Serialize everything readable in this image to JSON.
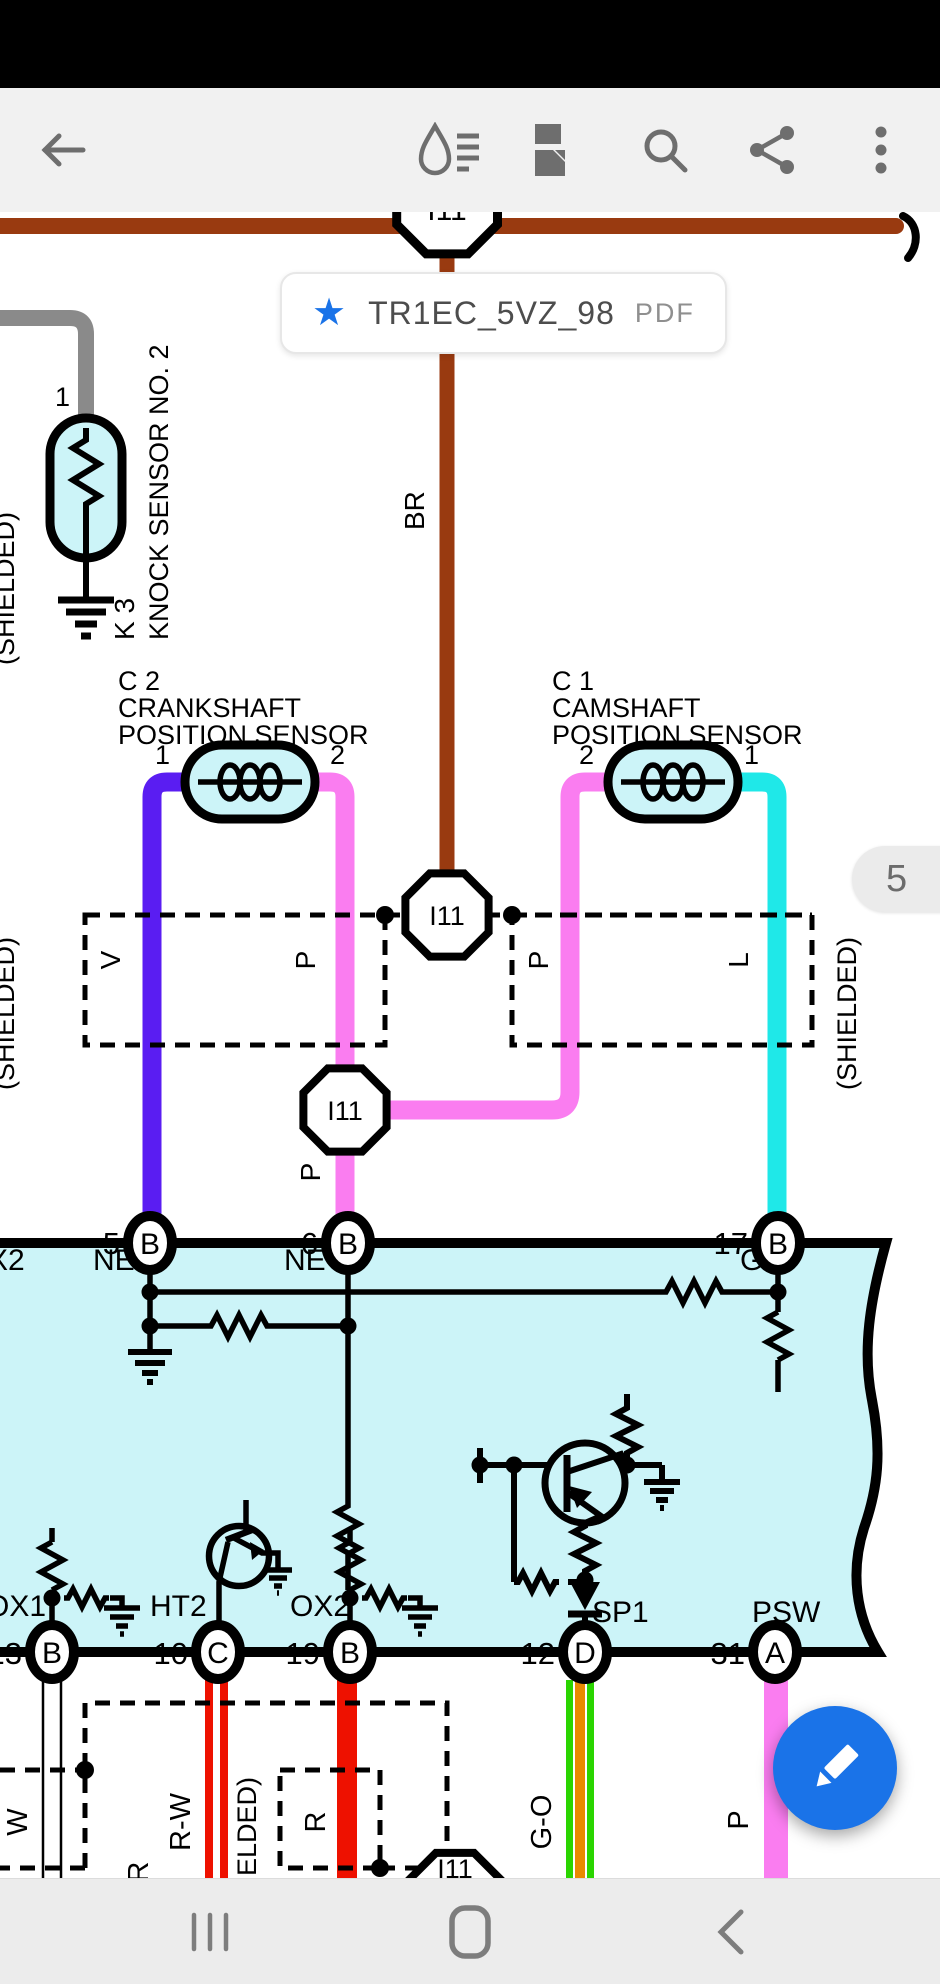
{
  "status_bar": {
    "background": "#000000"
  },
  "toolbar": {
    "background": "#f1f1f1",
    "icon_color": "#6e6e6e",
    "icons": [
      "back",
      "annotate",
      "page-layout",
      "search",
      "share",
      "more"
    ]
  },
  "doc_chip": {
    "title": "TR1EC_5VZ_98",
    "badge": "PDF",
    "star_color": "#1a73e8"
  },
  "page_indicator": {
    "label": "5"
  },
  "fab": {
    "icon": "pencil",
    "color": "#1a73e8"
  },
  "nav_bar": {
    "icons": [
      "recents",
      "home",
      "back"
    ]
  },
  "diagram": {
    "colors": {
      "ecu_fill": "#ccf4f8",
      "brown": "#993a10",
      "violet": "#5a1df2",
      "pink": "#fa7df0",
      "cyan": "#1fe8e8",
      "red": "#ee1100",
      "green": "#2ad500",
      "orange": "#e88a00",
      "gray": "#8a8a8a"
    },
    "connectors": {
      "top": "I11",
      "mid": "I11",
      "pink": "I11",
      "bottom": "I11"
    },
    "knock_sensor": {
      "pin": "1",
      "code": "K 3",
      "name": "KNOCK SENSOR NO. 2"
    },
    "shield_labels": {
      "upper_left": "(SHIELDED)",
      "mid_left": "(SHIELDED)",
      "right": "(SHIELDED)",
      "bottom": "(SHIELDED)"
    },
    "crank_sensor": {
      "code": "C 2",
      "name1": "CRANKSHAFT",
      "name2": "POSITION SENSOR",
      "pin_left": "1",
      "pin_right": "2"
    },
    "cam_sensor": {
      "code": "C 1",
      "name1": "CAMSHAFT",
      "name2": "POSITION SENSOR",
      "pin_left": "2",
      "pin_right": "1"
    },
    "wire_labels": {
      "br": "BR",
      "v": "V",
      "p_left_box": "P",
      "p_right_box": "P",
      "l": "L",
      "p_mid": "P",
      "w": "W",
      "or": "OR",
      "rw": "R-W",
      "r": "R",
      "go": "G-O",
      "oil": "OIL",
      "p_bottom": "P"
    },
    "ecu": {
      "clipped_label": "X2",
      "top_labels": {
        "ne_plus": "NE+",
        "ne_minus": "NE-",
        "g_plus": "G+"
      },
      "top_pins": [
        {
          "num": "5",
          "letter": "B"
        },
        {
          "num": "6",
          "letter": "B"
        },
        {
          "num": "17",
          "letter": "B"
        }
      ],
      "bottom_labels": {
        "ox1": "OX1",
        "ht2": "HT2",
        "ox2": "OX2",
        "sp1": "SP1",
        "psw": "PSW"
      },
      "bottom_pins": [
        {
          "num": "13",
          "letter": "B"
        },
        {
          "num": "10",
          "letter": "C"
        },
        {
          "num": "19",
          "letter": "B"
        },
        {
          "num": "12",
          "letter": "D"
        },
        {
          "num": "31",
          "letter": "A"
        }
      ]
    }
  }
}
